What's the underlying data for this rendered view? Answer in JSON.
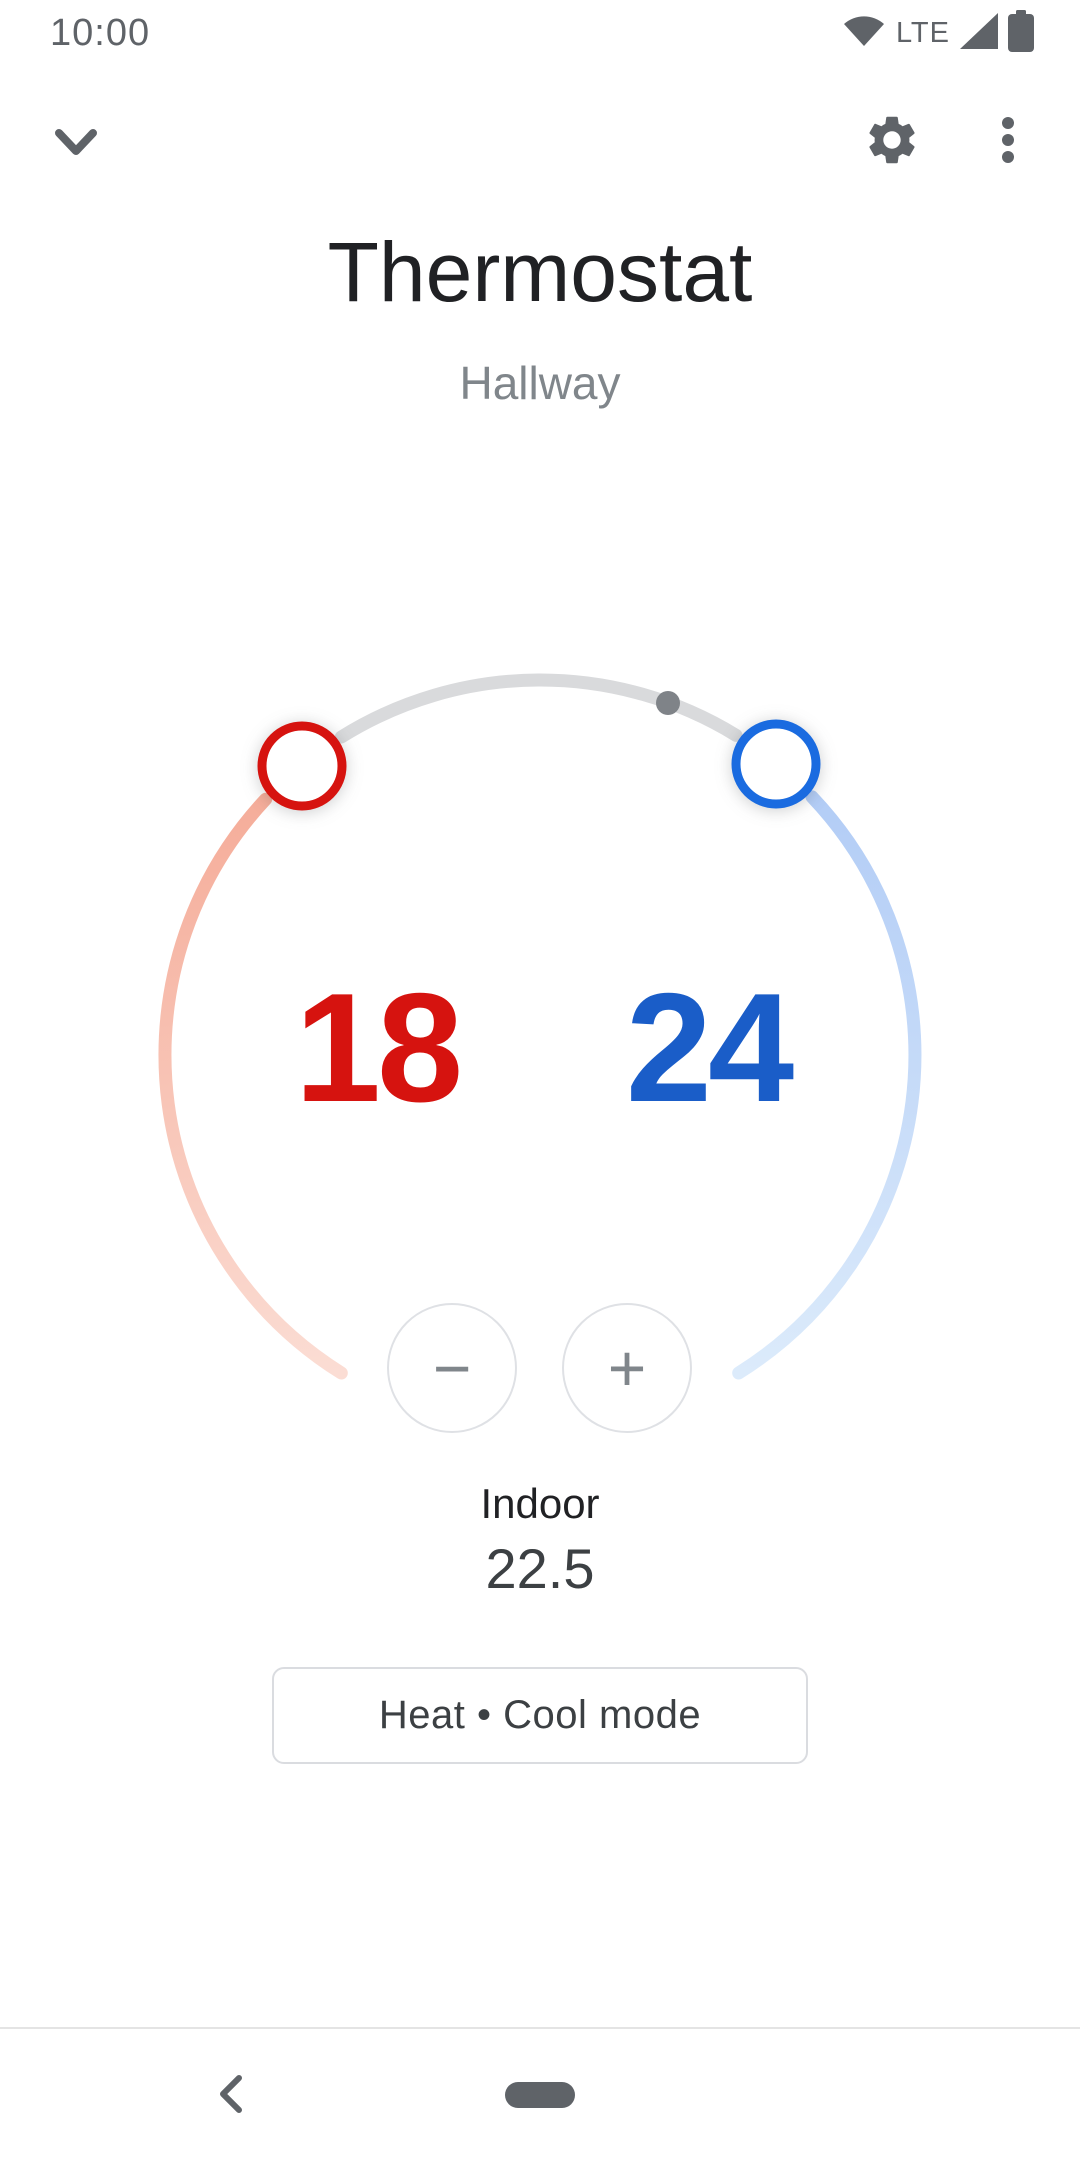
{
  "status_bar": {
    "time": "10:00",
    "network": "LTE"
  },
  "device": {
    "title": "Thermostat",
    "room": "Hallway"
  },
  "dial": {
    "heat_setpoint": "18",
    "cool_setpoint": "24",
    "current_temperature_marker": "22.5"
  },
  "controls": {
    "decrease_label": "−",
    "increase_label": "+"
  },
  "ambient": {
    "label": "Indoor",
    "value": "22.5"
  },
  "mode": {
    "label": "Heat • Cool mode"
  },
  "icons": [
    "wifi-icon",
    "signal-icon",
    "battery-icon",
    "chevron-down-icon",
    "gear-icon",
    "overflow-menu-icon",
    "minus-icon",
    "plus-icon",
    "back-chevron-icon",
    "home-pill"
  ],
  "colors": {
    "heat_accent": "#d6130f",
    "cool_accent": "#1a5dc8",
    "cool_handle": "#1a6be0",
    "heat_arc_start": "#f5ad9a",
    "heat_arc_end": "#fbddd4",
    "cool_arc_start": "#b3cdf6",
    "cool_arc_end": "#dcebfb",
    "range_arc": "#d9dadc",
    "current_dot": "#7f8388",
    "icon_gray": "#5f6368",
    "text_primary": "#202124",
    "text_secondary": "#80868b",
    "border_gray": "#dadce0"
  }
}
